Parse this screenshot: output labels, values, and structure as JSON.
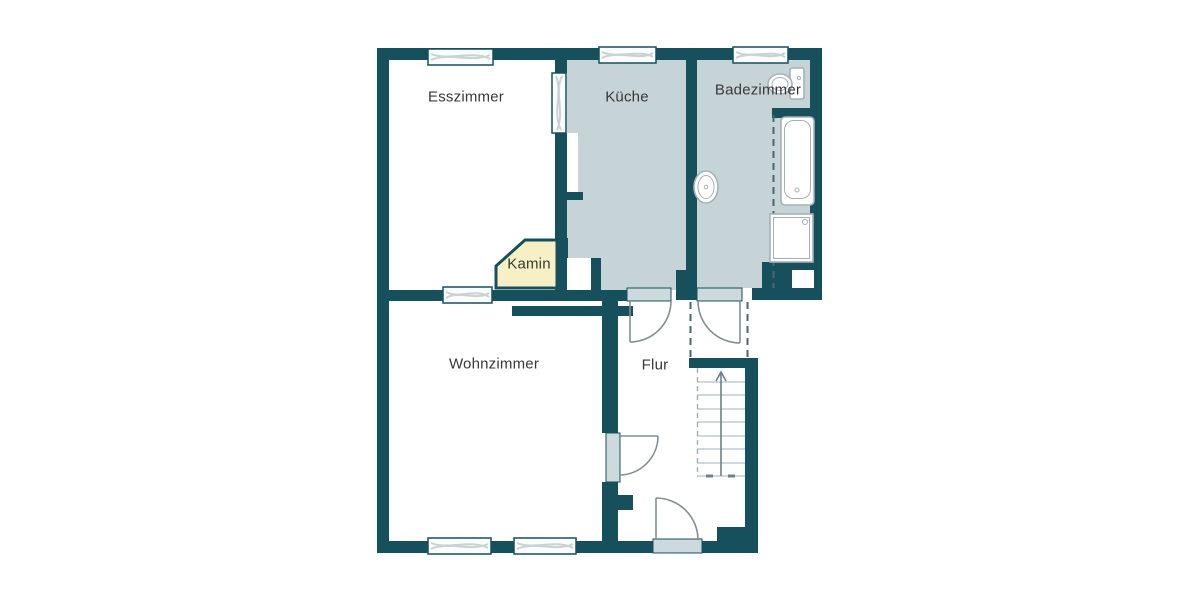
{
  "rooms": {
    "esszimmer": {
      "label": "Esszimmer"
    },
    "kueche": {
      "label": "Küche"
    },
    "badezimmer": {
      "label": "Badezimmer"
    },
    "kamin": {
      "label": "Kamin"
    },
    "wohnzimmer": {
      "label": "Wohnzimmer"
    },
    "flur": {
      "label": "Flur"
    }
  },
  "fixtures": {
    "badezimmer": [
      "toilet-icon",
      "bathtub-icon",
      "shower-icon",
      "washbasin-icon"
    ],
    "flur": [
      "staircase-up-icon"
    ],
    "kamin": [
      "fireplace-icon"
    ]
  },
  "colors": {
    "background": "#ffffff",
    "wall": "#15505c",
    "shaded-room": "#c6d4d8",
    "kamin-fill": "#f6f0c4",
    "window-fill": "#fbfdfd",
    "window-wave": "#c9d2d4",
    "door-threshold": "#ccdadd",
    "door-arc": "#808f93",
    "fixture-stroke": "#a3b2b6",
    "dash": "#4a676e",
    "stair-stroke": "#9fb0b4",
    "stair-rail": "#6b8287",
    "label-text": "#383838"
  }
}
